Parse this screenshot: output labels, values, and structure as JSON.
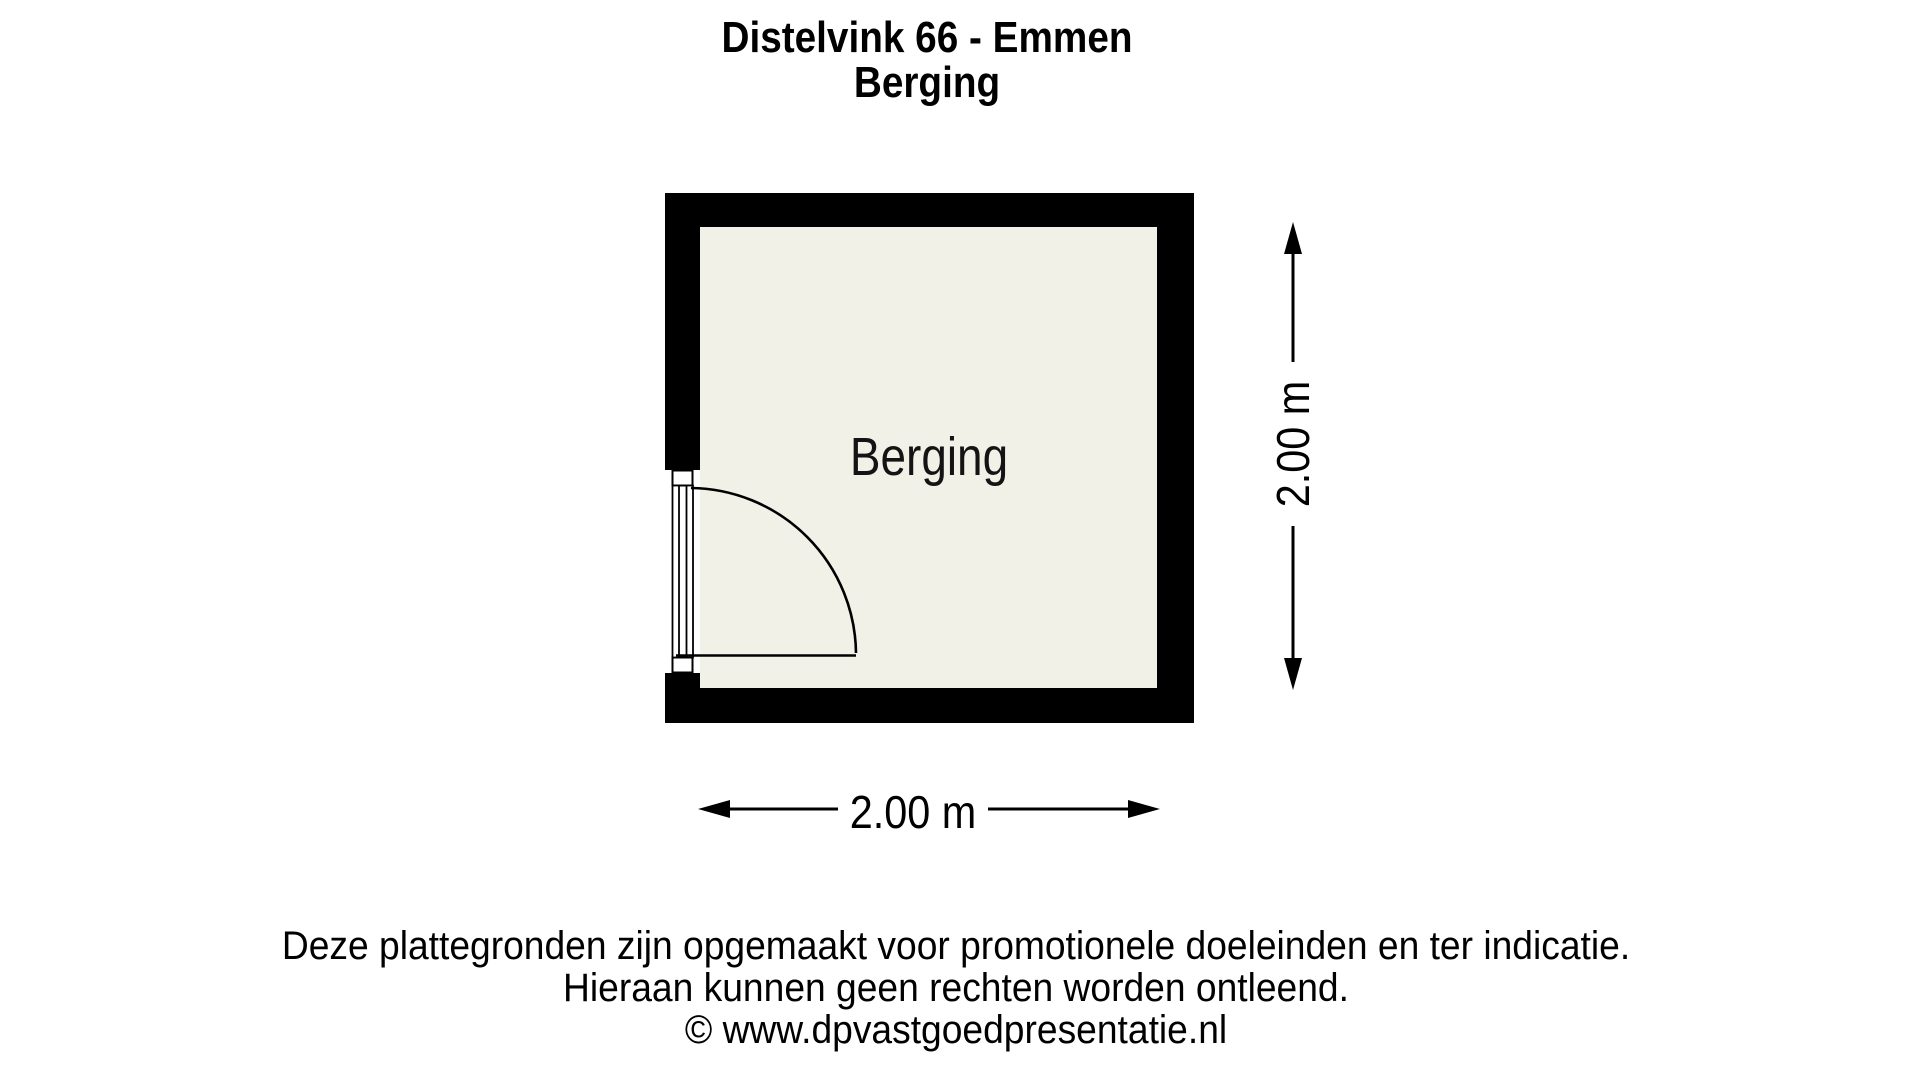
{
  "title": {
    "line1": "Distelvink 66 - Emmen",
    "line2": "Berging"
  },
  "room": {
    "label": "Berging"
  },
  "dimensions": {
    "width_label": "2.00 m",
    "height_label": "2.00 m"
  },
  "footer": {
    "line1": "Deze plattegronden zijn opgemaakt voor promotionele doeleinden en ter indicatie.",
    "line2": "Hieraan kunnen geen rechten worden ontleend.",
    "line3": "© www.dpvastgoedpresentatie.nl"
  },
  "colors": {
    "wall": "#000000",
    "floor": "#f2f1e8",
    "line": "#000000"
  }
}
